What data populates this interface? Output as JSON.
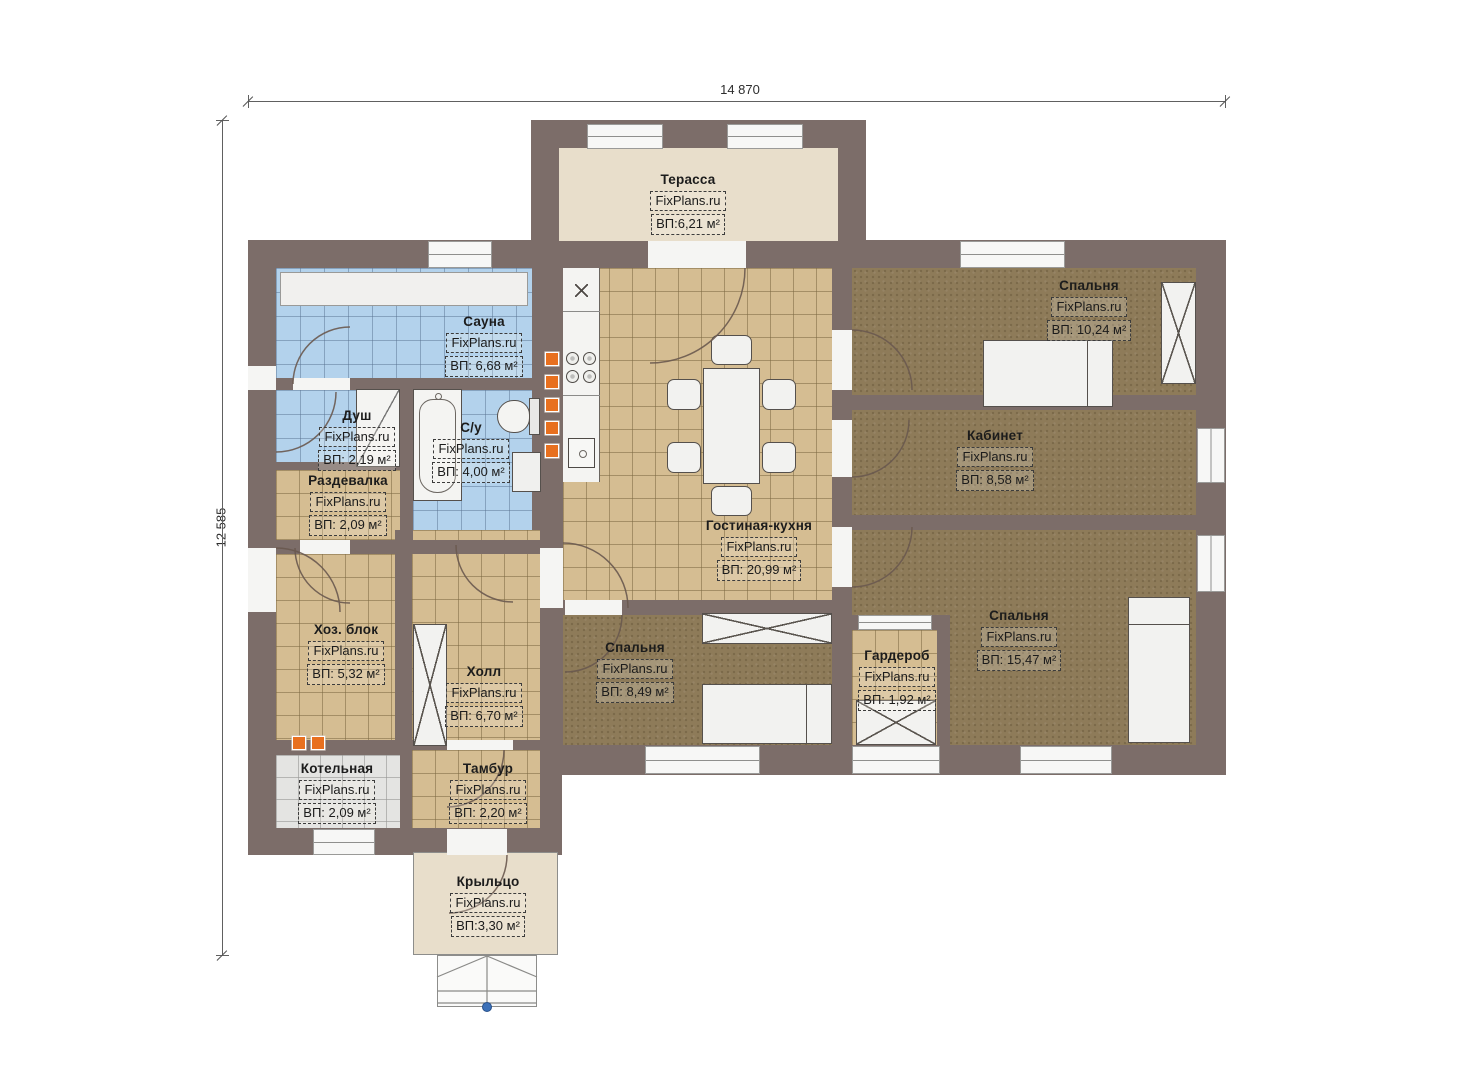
{
  "dimensions": {
    "width_label": "14 870",
    "height_label": "12 585"
  },
  "watermark": "FixPlans.ru",
  "rooms": [
    {
      "name": "Терасса",
      "area": "ВП:6,21 м²"
    },
    {
      "name": "Сауна",
      "area": "ВП: 6,68 м²"
    },
    {
      "name": "Душ",
      "area": "ВП: 2,19 м²"
    },
    {
      "name": "С/у",
      "area": "ВП: 4,00 м²"
    },
    {
      "name": "Раздевалка",
      "area": "ВП: 2,09 м²"
    },
    {
      "name": "Хоз. блок",
      "area": "ВП: 5,32 м²"
    },
    {
      "name": "Холл",
      "area": "ВП: 6,70 м²"
    },
    {
      "name": "Котельная",
      "area": "ВП: 2,09 м²"
    },
    {
      "name": "Тамбур",
      "area": "ВП: 2,20 м²"
    },
    {
      "name": "Крыльцо",
      "area": "ВП:3,30 м²"
    },
    {
      "name": "Гостиная-кухня",
      "area": "ВП: 20,99 м²"
    },
    {
      "name": "Спальня",
      "area": "ВП: 8,49 м²"
    },
    {
      "name": "Спальня",
      "area": "ВП: 10,24 м²"
    },
    {
      "name": "Кабинет",
      "area": "ВП: 8,58 м²"
    },
    {
      "name": "Спальня",
      "area": "ВП: 15,47 м²"
    },
    {
      "name": "Гардероб",
      "area": "ВП: 1,92 м²"
    }
  ],
  "colors": {
    "wall": "#7c6d69",
    "floor_tile_tan": "#d5bd92",
    "floor_carpet": "#8e7b59",
    "floor_tile_blue": "#b3d2ec",
    "floor_tile_grey": "#e4e4e2",
    "floor_terrace": "#e8decb",
    "accent_orange": "#e8701f",
    "window_white": "#f7f7f6",
    "marker_blue": "#3b70b8"
  }
}
